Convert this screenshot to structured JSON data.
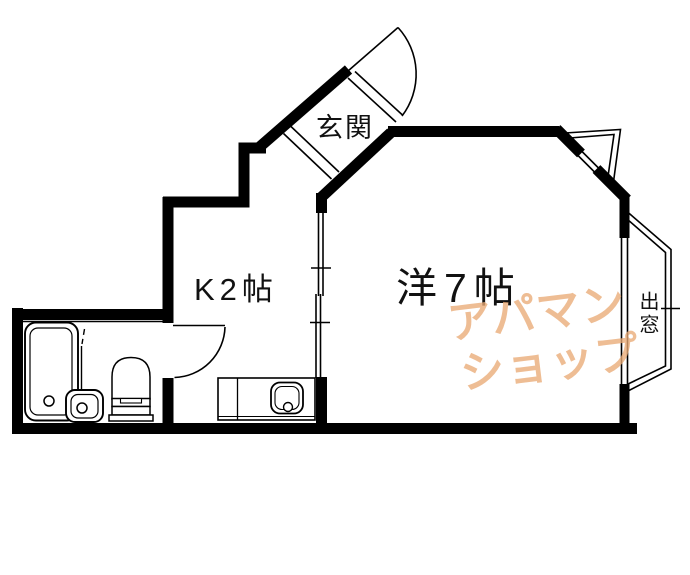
{
  "floorplan": {
    "rooms": {
      "entrance": {
        "label": "玄関"
      },
      "kitchen": {
        "label": "K2帖"
      },
      "main_room": {
        "label": "洋7帖"
      },
      "bay_window": {
        "label": "出窓"
      }
    },
    "fixtures": [
      "bathtub",
      "washbasin",
      "toilet",
      "kitchen-counter",
      "kitchen-sink",
      "entrance-door",
      "bathroom-door",
      "sliding-door",
      "window-right",
      "window-angled",
      "bay-window",
      "corner-window",
      "entrance-sill",
      "genkan-step"
    ],
    "colors": {
      "background": "#ffffff",
      "lines": "#000000",
      "watermark": "#e9aa76"
    }
  },
  "watermark": {
    "line1": "アパマン",
    "line2": "ショップ"
  }
}
